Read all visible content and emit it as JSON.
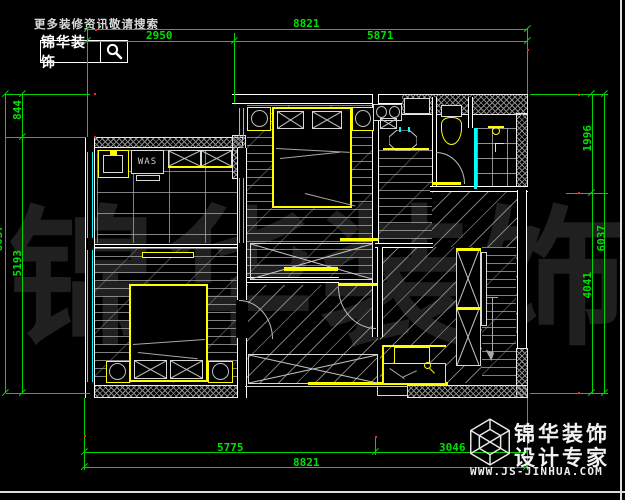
{
  "branding": {
    "search_hint": "更多装修资讯敬请搜索",
    "logo_text": "锦华装饰"
  },
  "watermark": {
    "text": "锦华装饰"
  },
  "plan": {
    "labels": {
      "washing_machine": "WAS"
    }
  },
  "dimensions": {
    "top": {
      "total": "8821",
      "left": "2950",
      "right": "5871"
    },
    "bottom": {
      "left": "5775",
      "right": "3046",
      "total": "8821"
    },
    "left": {
      "top": "844",
      "bottom": "5193",
      "total": "6037"
    },
    "right": {
      "top": "1996",
      "bottom": "4041",
      "total": "6037"
    }
  },
  "footer": {
    "brand_line1": "锦华装饰",
    "brand_line2": "设计专家",
    "website": "WWW.JS-JINHUA.COM"
  },
  "colors": {
    "dimension_green": "#00d400",
    "window_cyan": "#00ffff",
    "furniture_yellow": "#ffff00",
    "wall_white": "#ffffff",
    "hatch_gray": "#8a8a8a",
    "watermark_gray": "#202020",
    "defpoint_red": "#ff2020",
    "background": "#000000"
  }
}
